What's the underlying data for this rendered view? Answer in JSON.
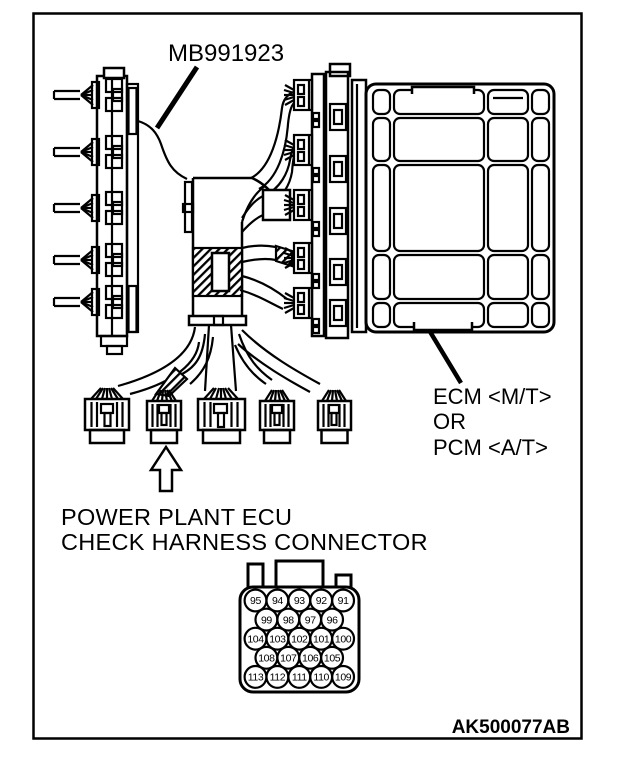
{
  "figure": {
    "tool_label": "MB991923",
    "module_label": {
      "line1": "ECM <M/T>",
      "line2": "OR",
      "line3": "PCM <A/T>"
    },
    "caption": {
      "line1": "POWER PLANT ECU",
      "line2": "CHECK HARNESS CONNECTOR"
    },
    "figure_code": "AK500077AB"
  },
  "pinout": {
    "rows": [
      {
        "pins": [
          "95",
          "94",
          "93",
          "92",
          "91"
        ]
      },
      {
        "pins": [
          "99",
          "98",
          "97",
          "96"
        ]
      },
      {
        "pins": [
          "104",
          "103",
          "102",
          "101",
          "100"
        ]
      },
      {
        "pins": [
          "108",
          "107",
          "106",
          "105"
        ]
      },
      {
        "pins": [
          "113",
          "112",
          "111",
          "110",
          "109"
        ]
      }
    ]
  },
  "colors": {
    "line": "#000000",
    "background": "#ffffff"
  }
}
